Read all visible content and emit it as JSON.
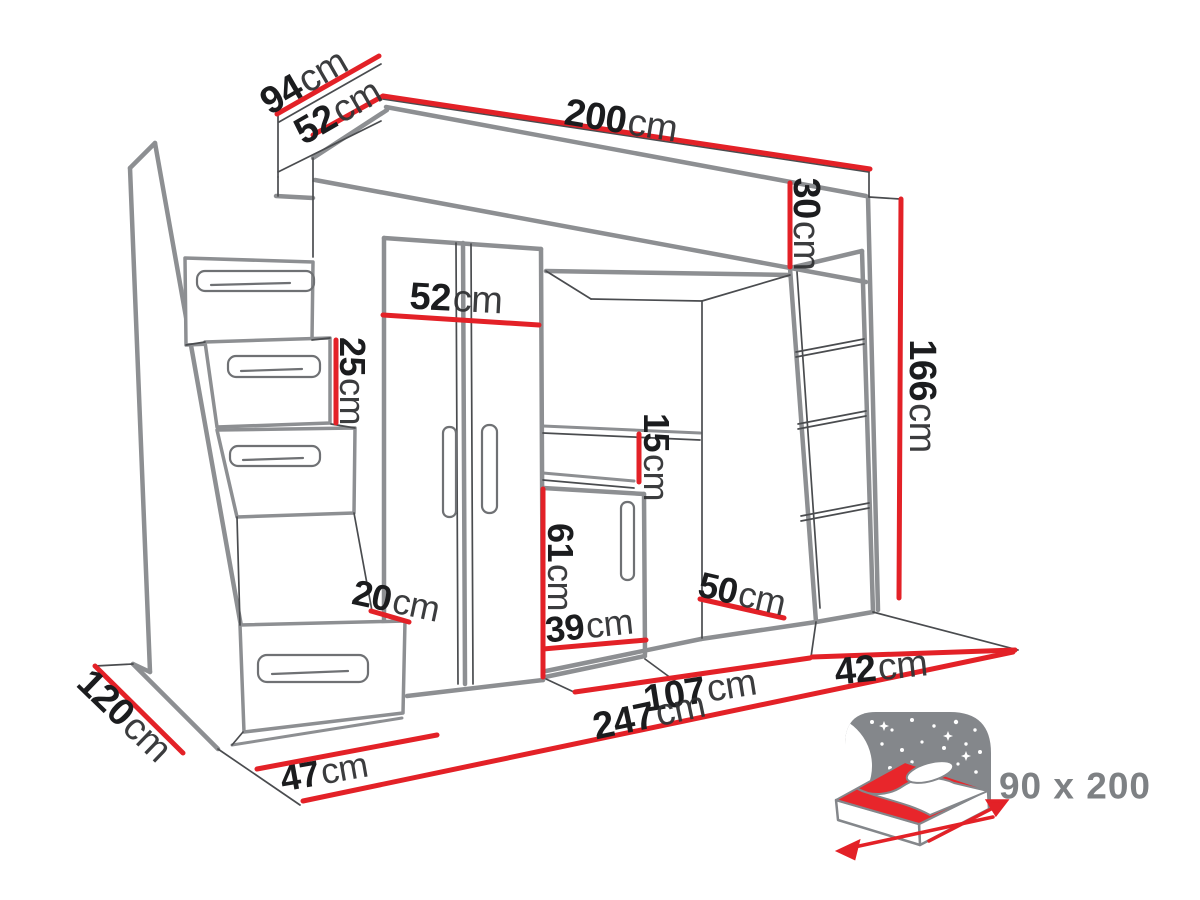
{
  "diagram": {
    "kind": "furniture-dimension-line-art",
    "subject": "loft bed with stairs, wardrobe, desk niche and bookcase",
    "accent_color": "#e32127",
    "line_color": "#8d8f92",
    "unit": "cm"
  },
  "dimensions": [
    {
      "id": "bed-top-depth",
      "value": "94",
      "unit": "cm"
    },
    {
      "id": "bed-side-height",
      "value": "52",
      "unit": "cm"
    },
    {
      "id": "bed-length",
      "value": "200",
      "unit": "cm"
    },
    {
      "id": "bed-frame-height",
      "value": "30",
      "unit": "cm"
    },
    {
      "id": "underbed-height",
      "value": "166",
      "unit": "cm"
    },
    {
      "id": "wardrobe-width",
      "value": "52",
      "unit": "cm"
    },
    {
      "id": "drawer-height",
      "value": "25",
      "unit": "cm"
    },
    {
      "id": "desk-clearance",
      "value": "15",
      "unit": "cm"
    },
    {
      "id": "cabinet-height",
      "value": "61",
      "unit": "cm"
    },
    {
      "id": "cabinet-width",
      "value": "39",
      "unit": "cm"
    },
    {
      "id": "step-rise",
      "value": "20",
      "unit": "cm"
    },
    {
      "id": "bookcase-depth",
      "value": "50",
      "unit": "cm"
    },
    {
      "id": "bookcase-width",
      "value": "42",
      "unit": "cm"
    },
    {
      "id": "niche-width",
      "value": "107",
      "unit": "cm"
    },
    {
      "id": "total-length",
      "value": "247",
      "unit": "cm"
    },
    {
      "id": "stairs-width",
      "value": "47",
      "unit": "cm"
    },
    {
      "id": "total-depth",
      "value": "120",
      "unit": "cm"
    }
  ],
  "bed_size_label": {
    "value": "90 x 200"
  }
}
